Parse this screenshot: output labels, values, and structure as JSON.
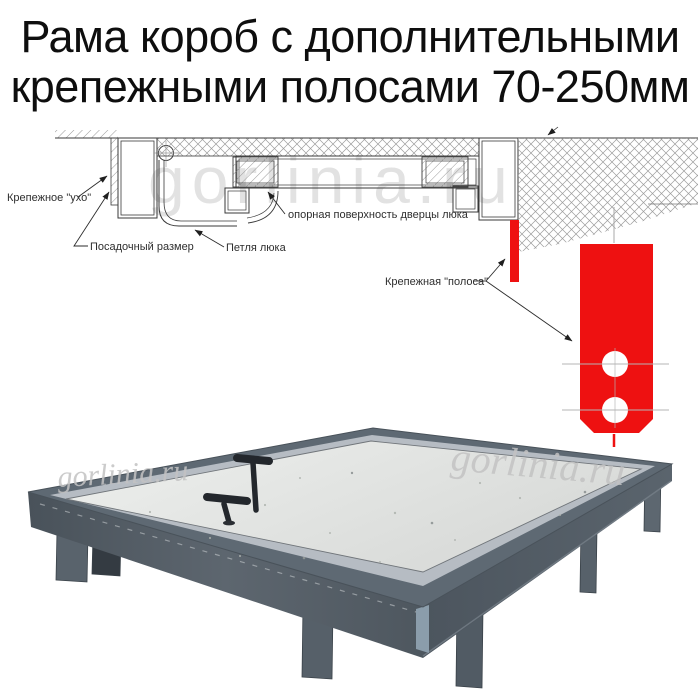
{
  "title": {
    "line1": "Рама короб с дополнительными",
    "line2": "крепежными полосами 70-250мм"
  },
  "watermark": {
    "text": "gorlinia.ru"
  },
  "diagram": {
    "labels": {
      "ear": "Крепежное \"ухо\"",
      "seat_size": "Посадочный размер",
      "hinge": "Петля люка",
      "support_surface": "опорная поверхность дверцы люка",
      "strip": "Крепежная \"полоса\""
    },
    "strip_color": "#ee1111",
    "line_color": "#3a3a3a"
  },
  "photo": {
    "frame_color": "#5e6973",
    "lip_color": "#b6bcc3",
    "door_color": "#e3e4e2",
    "handle_color": "#23272c",
    "leg_color": "#57616a"
  }
}
